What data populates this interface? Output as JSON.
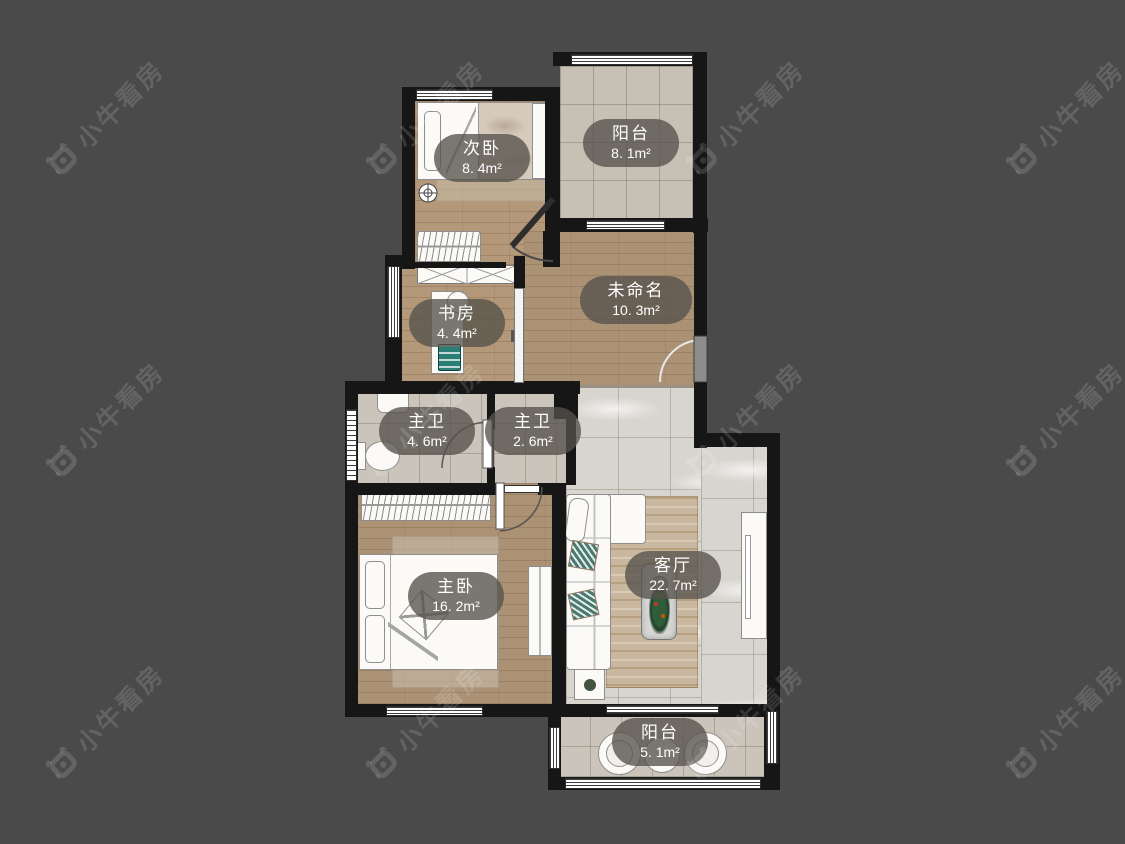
{
  "watermark": {
    "text": "小牛看房"
  },
  "rooms": [
    {
      "name": "次卧",
      "area": "8. 4m²"
    },
    {
      "name": "阳台",
      "area": "8. 1m²"
    },
    {
      "name": "未命名",
      "area": "10. 3m²"
    },
    {
      "name": "书房",
      "area": "4. 4m²"
    },
    {
      "name": "主卫",
      "area": "4. 6m²"
    },
    {
      "name": "主卫",
      "area": "2. 6m²"
    },
    {
      "name": "主卧",
      "area": "16. 2m²"
    },
    {
      "name": "客厅",
      "area": "22. 7m²"
    },
    {
      "name": "阳台",
      "area": "5. 1m²"
    }
  ],
  "colors": {
    "background": "#4a4a4a",
    "wall": "#161616",
    "wood_floor": "#b39879",
    "tile_floor": "#c8c2b8",
    "marble_floor": "#d8d4ce",
    "label_pill": "rgba(86,82,75,0.78)",
    "watermark_text": "rgba(255,255,255,0.14)"
  }
}
